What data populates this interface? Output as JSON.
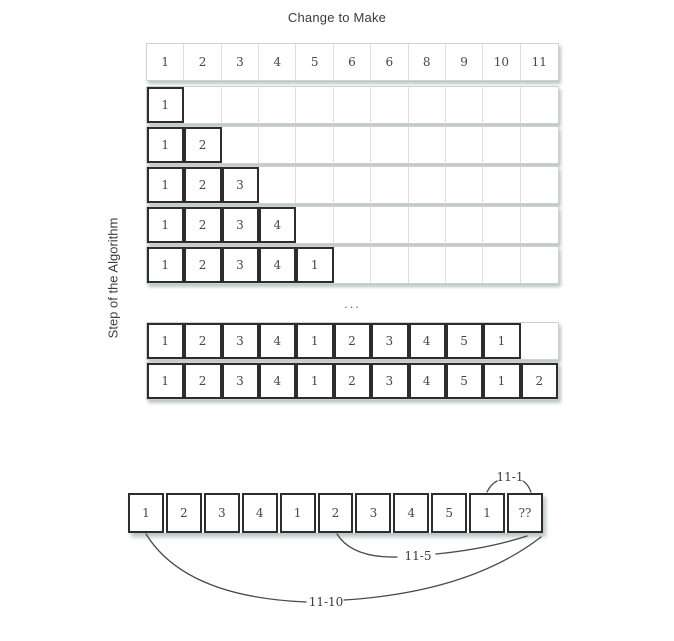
{
  "title": "Change to Make",
  "axis": {
    "y_label": "Step of the Algorithm"
  },
  "grid": {
    "columns": 11,
    "header": [
      "1",
      "2",
      "3",
      "4",
      "5",
      "6",
      "6",
      "8",
      "9",
      "10",
      "11"
    ],
    "step_rows": [
      {
        "values": [
          "1"
        ]
      },
      {
        "values": [
          "1",
          "2"
        ]
      },
      {
        "values": [
          "1",
          "2",
          "3"
        ]
      },
      {
        "values": [
          "1",
          "2",
          "3",
          "4"
        ]
      },
      {
        "values": [
          "1",
          "2",
          "3",
          "4",
          "1"
        ]
      }
    ],
    "ellipsis": "...",
    "later_rows": [
      {
        "values": [
          "1",
          "2",
          "3",
          "4",
          "1",
          "2",
          "3",
          "4",
          "5",
          "1"
        ]
      },
      {
        "values": [
          "1",
          "2",
          "3",
          "4",
          "1",
          "2",
          "3",
          "4",
          "5",
          "1",
          "2"
        ]
      }
    ]
  },
  "bottom": {
    "cells": [
      "1",
      "2",
      "3",
      "4",
      "1",
      "2",
      "3",
      "4",
      "5",
      "1",
      "??"
    ],
    "annotations": {
      "minus_one": "11-1",
      "minus_five": "11-5",
      "minus_ten": "11-10"
    }
  },
  "colors": {
    "filled_border": "#2d2d2d",
    "strip_border": "#cdd1d2",
    "cell_separator": "#dddfe0",
    "text": "#474747",
    "arc_stroke": "#4a4a4a",
    "background": "#ffffff"
  }
}
